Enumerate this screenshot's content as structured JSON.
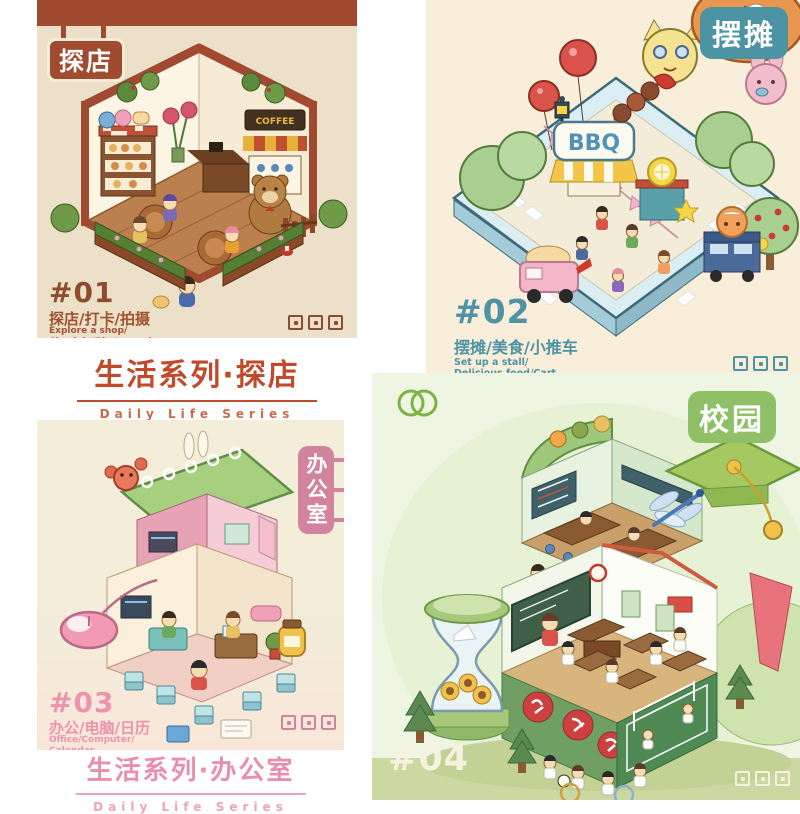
{
  "page": {
    "background": "#ffffff"
  },
  "poster1": {
    "badge": "探店",
    "number": "#01",
    "tags_zh": "探店/打卡/拍摄",
    "tags_en1": "Explore a shop/",
    "tags_en2": "Check in/Photograph",
    "sign": "COFFEE",
    "colors": {
      "background": "#ece0c9",
      "accent": "#a04a2f",
      "text": "#8f4b2e"
    }
  },
  "caption1": {
    "title": "生活系列·探店",
    "subtitle": "Daily Life Series",
    "color": "#c14a2b"
  },
  "poster2": {
    "badge": "摆摊",
    "number": "#02",
    "tags_zh": "摆摊/美食/小推车",
    "tags_en1": "Set up a stall/",
    "tags_en2": "Delicious food/Cart",
    "sign": "BBQ",
    "colors": {
      "background": "#f9eeda",
      "accent": "#4c93a4"
    }
  },
  "poster3": {
    "badge": "办公室",
    "number": "#03",
    "tags_zh": "办公/电脑/日历",
    "tags_en1": "Office/Computer/",
    "tags_en2": "Calendar",
    "colors": {
      "background": "#f3edda",
      "accent": "#ee93ad",
      "badge_bg": "#d2849f"
    }
  },
  "caption3": {
    "title": "生活系列·办公室",
    "subtitle": "Daily Life Series",
    "color": "#e88fb0"
  },
  "poster4": {
    "badge": "校园",
    "number": "#04",
    "colors": {
      "background": "#eef5e2",
      "accent": "#8fc068",
      "number_color": "#f6f2df"
    }
  },
  "watermarks": {
    "count_per_poster": 3,
    "icon": "stamp-icon"
  }
}
